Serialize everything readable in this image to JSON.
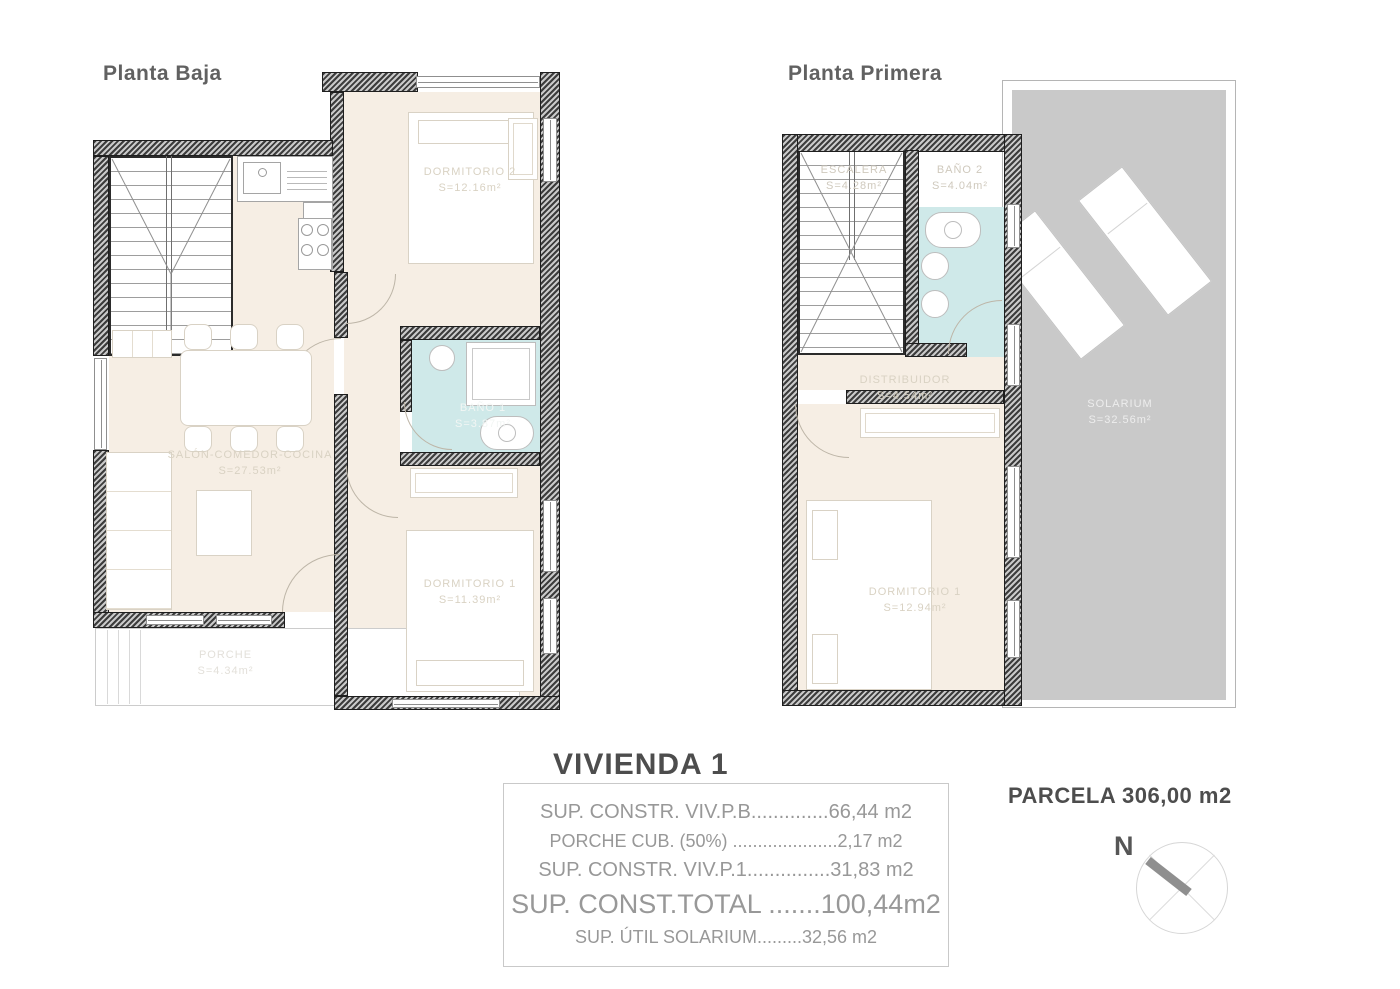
{
  "titles": {
    "left_plan": "Planta Baja",
    "right_plan": "Planta Primera"
  },
  "planta_baja": {
    "dormitorio2": {
      "name": "DORMITORIO 2",
      "area": "S=12.16m²"
    },
    "bano1": {
      "name": "BAÑO 1",
      "area": "S=3.87m²"
    },
    "salon": {
      "name": "SALÓN-COMEDOR-COCINA",
      "area": "S=27.53m²"
    },
    "dormitorio1": {
      "name": "DORMITORIO 1",
      "area": "S=11.39m²"
    },
    "porche": {
      "name": "PORCHE",
      "area": "S=4.34m²"
    }
  },
  "planta_primera": {
    "escalera": {
      "name": "ESCALERA",
      "area": "S=4.28m²"
    },
    "bano2": {
      "name": "BAÑO 2",
      "area": "S=4.04m²"
    },
    "distribuidor": {
      "name": "DISTRIBUIDOR",
      "area": "S=4.54m²"
    },
    "dormitorio1": {
      "name": "DORMITORIO 1",
      "area": "S=12.94m²"
    },
    "solarium": {
      "name": "SOLARIUM",
      "area": "S=32.56m²"
    }
  },
  "summary": {
    "title": "VIVIENDA 1",
    "rows": [
      "SUP. CONSTR. VIV.P.B..............66,44 m2",
      "PORCHE CUB. (50%) .....................2,17 m2",
      "SUP. CONSTR. VIV.P.1...............31,83 m2",
      "SUP. CONST.TOTAL .......100,44m2",
      "SUP. ÚTIL SOLARIUM.........32,56 m2"
    ]
  },
  "parcel": {
    "label": "PARCELA 306,00 m2"
  },
  "compass": {
    "north": "N"
  },
  "colors": {
    "floor_beige": "#f6eee4",
    "bath_blue": "#cfe9e9",
    "solarium_gray": "#c9c9c9",
    "wall_dark": "#3c3c3c",
    "title_gray": "#616161",
    "summary_gray": "#989898"
  }
}
